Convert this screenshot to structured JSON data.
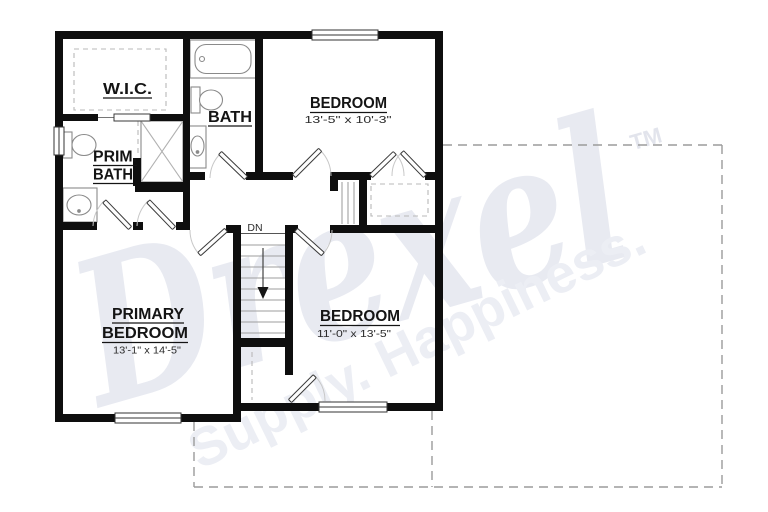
{
  "watermark": {
    "brand": "Drexel",
    "tm": "TM",
    "tagline": "Supply. Happiness."
  },
  "rooms": {
    "wic": {
      "label": "W.I.C."
    },
    "bath": {
      "label": "BATH"
    },
    "prim_bath": {
      "line1": "PRIM.",
      "line2": "BATH"
    },
    "bedroom_top": {
      "label": "BEDROOM",
      "dims": "13'-5\" x 10'-3\""
    },
    "primary_bedroom": {
      "line1": "PRIMARY",
      "line2": "BEDROOM",
      "dims": "13'-1\" x 14'-5\""
    },
    "bedroom_bottom": {
      "label": "BEDROOM",
      "dims": "11'-0\" x 13'-5\""
    }
  },
  "stairs": {
    "dn_label": "DN"
  },
  "colors": {
    "wall": "#0e0e0e",
    "fixture_line": "#8a8a8a",
    "door_arc": "#c8c8c8",
    "dashed_outline": "#9b9b9b",
    "watermark_gray": "#e8eaf1"
  }
}
